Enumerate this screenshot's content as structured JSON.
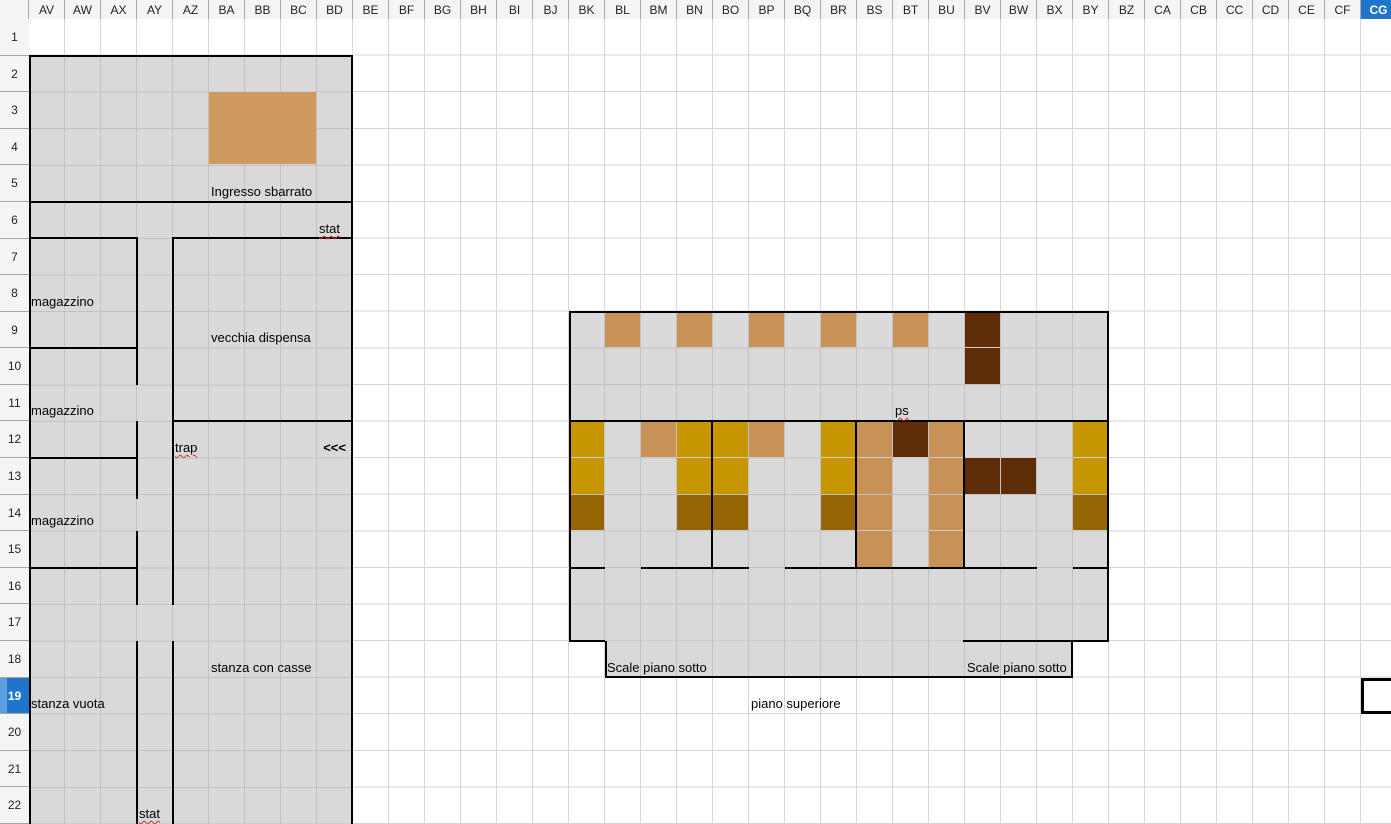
{
  "sheet": {
    "columns": [
      "AV",
      "AW",
      "AX",
      "AY",
      "AZ",
      "BA",
      "BB",
      "BC",
      "BD",
      "BE",
      "BF",
      "BG",
      "BH",
      "BI",
      "BJ",
      "BK",
      "BL",
      "BM",
      "BN",
      "BO",
      "BP",
      "BQ",
      "BR",
      "BS",
      "BT",
      "BU",
      "BV",
      "BW",
      "BX",
      "BY",
      "BZ",
      "CA",
      "CB",
      "CC",
      "CD",
      "CE",
      "CF",
      "CG"
    ],
    "row_count": 22,
    "selection": {
      "column": "CG",
      "row": 19
    }
  },
  "colors": {
    "map_fill": "#D9D9D9",
    "entrance": "#D0995F",
    "tan": "#C89155",
    "gold": "#C79500",
    "dark_gold": "#966605",
    "dark_brown": "#5E2D08",
    "header_selected": "#1F74CB",
    "header_selected_light": "#5C9FDD",
    "spell_underline": "#D03333"
  },
  "map": {
    "regions": [
      [
        29,
        56,
        324,
        768
      ],
      [
        569,
        312,
        540,
        329
      ],
      [
        605,
        641,
        468,
        36
      ]
    ],
    "cells": [
      {
        "c": "BA",
        "r": 3,
        "w": 3,
        "h": 2,
        "k": "entrance"
      },
      {
        "c": "BL",
        "r": 9,
        "k": "tan"
      },
      {
        "c": "BN",
        "r": 9,
        "k": "tan"
      },
      {
        "c": "BP",
        "r": 9,
        "k": "tan"
      },
      {
        "c": "BR",
        "r": 9,
        "k": "tan"
      },
      {
        "c": "BT",
        "r": 9,
        "k": "tan"
      },
      {
        "c": "BV",
        "r": 9,
        "k": "dark_brown"
      },
      {
        "c": "BV",
        "r": 10,
        "k": "dark_brown"
      },
      {
        "c": "BK",
        "r": 12,
        "k": "gold"
      },
      {
        "c": "BM",
        "r": 12,
        "k": "tan"
      },
      {
        "c": "BN",
        "r": 12,
        "k": "gold"
      },
      {
        "c": "BO",
        "r": 12,
        "k": "gold"
      },
      {
        "c": "BP",
        "r": 12,
        "k": "tan"
      },
      {
        "c": "BR",
        "r": 12,
        "k": "gold"
      },
      {
        "c": "BS",
        "r": 12,
        "k": "tan"
      },
      {
        "c": "BT",
        "r": 12,
        "k": "dark_brown"
      },
      {
        "c": "BU",
        "r": 12,
        "k": "tan"
      },
      {
        "c": "BY",
        "r": 12,
        "k": "gold"
      },
      {
        "c": "BK",
        "r": 13,
        "k": "gold"
      },
      {
        "c": "BN",
        "r": 13,
        "k": "gold"
      },
      {
        "c": "BO",
        "r": 13,
        "k": "gold"
      },
      {
        "c": "BR",
        "r": 13,
        "k": "gold"
      },
      {
        "c": "BS",
        "r": 13,
        "k": "tan"
      },
      {
        "c": "BU",
        "r": 13,
        "k": "tan"
      },
      {
        "c": "BV",
        "r": 13,
        "k": "dark_brown"
      },
      {
        "c": "BW",
        "r": 13,
        "k": "dark_brown"
      },
      {
        "c": "BY",
        "r": 13,
        "k": "gold"
      },
      {
        "c": "BK",
        "r": 14,
        "k": "dark_gold"
      },
      {
        "c": "BN",
        "r": 14,
        "k": "dark_gold"
      },
      {
        "c": "BO",
        "r": 14,
        "k": "dark_gold"
      },
      {
        "c": "BR",
        "r": 14,
        "k": "dark_gold"
      },
      {
        "c": "BS",
        "r": 14,
        "k": "tan"
      },
      {
        "c": "BU",
        "r": 14,
        "k": "tan"
      },
      {
        "c": "BY",
        "r": 14,
        "k": "dark_gold"
      },
      {
        "c": "BS",
        "r": 15,
        "k": "tan"
      },
      {
        "c": "BU",
        "r": 15,
        "k": "tan"
      }
    ],
    "walls": [
      [
        29,
        55,
        324,
        2
      ],
      [
        29,
        55,
        2,
        769
      ],
      [
        351,
        55,
        2,
        769
      ],
      [
        29,
        201,
        324,
        2
      ],
      [
        29,
        237,
        109,
        2
      ],
      [
        172,
        237,
        181,
        2
      ],
      [
        136,
        238,
        2,
        147
      ],
      [
        136,
        421,
        2,
        78
      ],
      [
        136,
        531,
        2,
        74
      ],
      [
        136,
        641,
        2,
        183
      ],
      [
        172,
        237,
        2,
        368
      ],
      [
        172,
        641,
        2,
        183
      ],
      [
        29,
        347,
        108,
        2
      ],
      [
        29,
        457,
        108,
        2
      ],
      [
        29,
        567,
        108,
        2
      ],
      [
        172,
        420,
        181,
        2
      ],
      [
        569,
        311,
        540,
        2
      ],
      [
        569,
        311,
        2,
        331
      ],
      [
        1107,
        311,
        2,
        331
      ],
      [
        569,
        420,
        540,
        2
      ],
      [
        711,
        421,
        2,
        146
      ],
      [
        855,
        421,
        2,
        146
      ],
      [
        963,
        421,
        2,
        146
      ],
      [
        569,
        567,
        36,
        2
      ],
      [
        641,
        567,
        108,
        2
      ],
      [
        785,
        567,
        252,
        2
      ],
      [
        1073,
        567,
        36,
        2
      ],
      [
        569,
        640,
        36,
        2
      ],
      [
        963,
        640,
        146,
        2
      ],
      [
        605,
        641,
        2,
        36
      ],
      [
        1071,
        641,
        2,
        36
      ],
      [
        605,
        676,
        468,
        2
      ]
    ],
    "labels": [
      {
        "text": "Ingresso sbarrato",
        "c": "BA",
        "r": 5
      },
      {
        "text": "stat",
        "c": "BD",
        "r": 6,
        "spell": true
      },
      {
        "text": "magazzino",
        "c": "AV",
        "r": 8
      },
      {
        "text": "vecchia dispensa",
        "c": "BA",
        "r": 9
      },
      {
        "text": "magazzino",
        "c": "AV",
        "r": 11
      },
      {
        "text": "trap",
        "c": "AZ",
        "r": 12,
        "spell": true
      },
      {
        "text": "<<<",
        "c": "BD",
        "r": 12,
        "bold": true,
        "right": true
      },
      {
        "text": "magazzino",
        "c": "AV",
        "r": 14
      },
      {
        "text": "ps",
        "c": "BT",
        "r": 11,
        "spell": true
      },
      {
        "text": "stanza con casse",
        "c": "BA",
        "r": 18
      },
      {
        "text": "Scale piano sotto",
        "c": "BL",
        "r": 18
      },
      {
        "text": "Scale piano sotto",
        "c": "BV",
        "r": 18
      },
      {
        "text": "stanza vuota",
        "c": "AV",
        "r": 19
      },
      {
        "text": "piano superiore",
        "c": "BP",
        "r": 19
      },
      {
        "text": "stat",
        "c": "AY",
        "r": 22,
        "spell": true
      }
    ]
  }
}
